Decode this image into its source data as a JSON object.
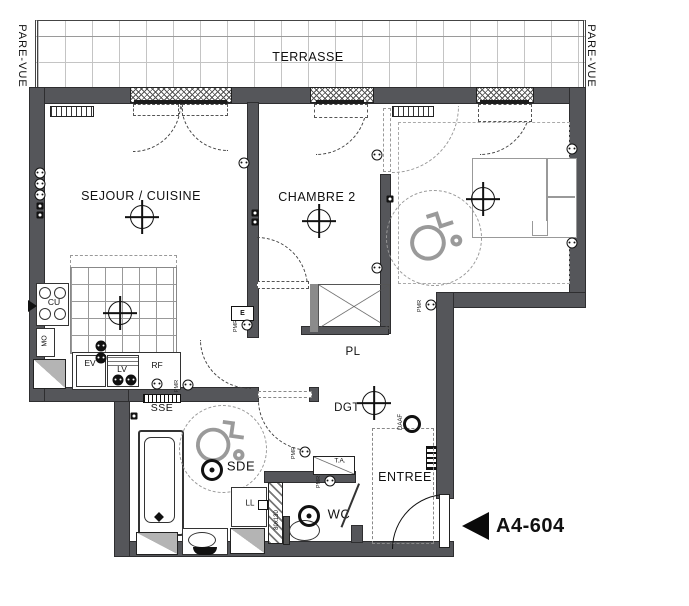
{
  "sheet": {
    "unit_label": "A4-604"
  },
  "labels": {
    "terrasse": "TERRASSE",
    "pare_vue": "PARE-VUE",
    "sejour": "SEJOUR / CUISINE",
    "chambre2": "CHAMBRE 2",
    "chambre1": "CHAMBRE 1",
    "pl": "PL",
    "dgt": "DGT",
    "entree": "ENTREE",
    "sde": "SDE",
    "wc": "WC",
    "sse": "SSE",
    "cu": "CU",
    "mo": "MO",
    "ev": "EV",
    "lv": "LV",
    "rf": "RF",
    "ll": "LL",
    "ta": "T.A.",
    "e": "E",
    "daaf": "DAAF",
    "pmr": "PMR",
    "wc_dim": "80x130"
  },
  "colors": {
    "wall": "#55565a",
    "line": "#111111",
    "furniture": "#999999",
    "terrace_grid": "#c4c4c4"
  },
  "symbols": {
    "ceiling_lights": [
      {
        "x": 142,
        "y": 217
      },
      {
        "x": 120,
        "y": 313
      },
      {
        "x": 319,
        "y": 221
      },
      {
        "x": 483,
        "y": 199
      },
      {
        "x": 374,
        "y": 403
      }
    ],
    "spotlights": [
      {
        "x": 212,
        "y": 470
      },
      {
        "x": 309,
        "y": 516
      }
    ],
    "smoke_detector": {
      "x": 412,
      "y": 424
    },
    "outlets": [
      {
        "x": 40,
        "y": 173
      },
      {
        "x": 40,
        "y": 184
      },
      {
        "x": 40,
        "y": 195
      },
      {
        "x": 244,
        "y": 163
      },
      {
        "x": 377,
        "y": 155
      },
      {
        "x": 377,
        "y": 268
      },
      {
        "x": 572,
        "y": 149
      },
      {
        "x": 572,
        "y": 243
      },
      {
        "x": 101,
        "y": 346,
        "dark": true
      },
      {
        "x": 101,
        "y": 358,
        "dark": true
      },
      {
        "x": 118,
        "y": 380,
        "dark": true
      },
      {
        "x": 131,
        "y": 380,
        "dark": true
      },
      {
        "x": 157,
        "y": 384
      },
      {
        "x": 188,
        "y": 385,
        "pmr": true
      },
      {
        "x": 247,
        "y": 325,
        "pmr": true
      },
      {
        "x": 431,
        "y": 305,
        "pmr": true
      },
      {
        "x": 305,
        "y": 452,
        "pmr": true
      },
      {
        "x": 330,
        "y": 481,
        "pmr": true
      }
    ],
    "switches": [
      {
        "x": 40,
        "y": 206
      },
      {
        "x": 40,
        "y": 215
      },
      {
        "x": 255,
        "y": 213
      },
      {
        "x": 255,
        "y": 222
      },
      {
        "x": 390,
        "y": 199
      },
      {
        "x": 134,
        "y": 416
      }
    ]
  }
}
